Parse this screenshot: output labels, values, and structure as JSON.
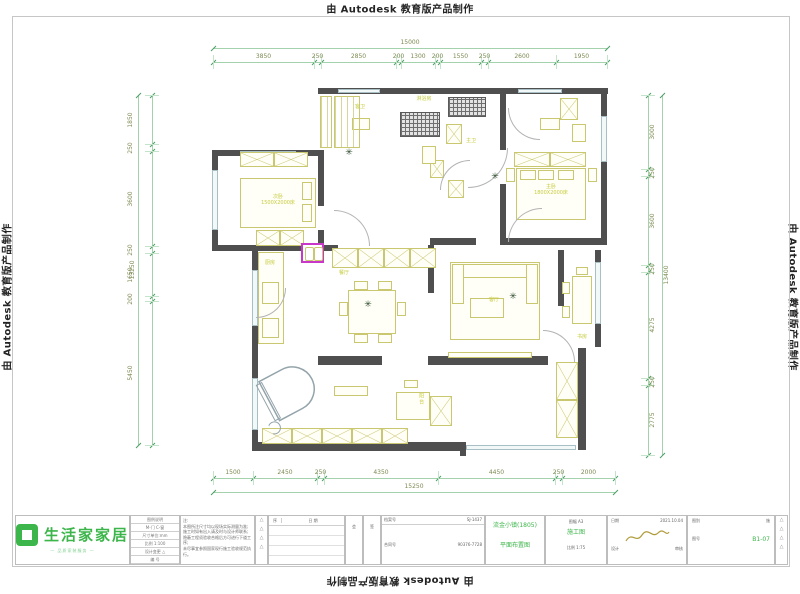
{
  "watermark": {
    "text": "由 Autodesk 教育版产品制作"
  },
  "plan": {
    "rooms": [
      {
        "label": "次卧",
        "sub": "1500X2000床",
        "x": 278,
        "y": 200,
        "vertical": false
      },
      {
        "label": "主卧",
        "sub": "1800X2000床",
        "x": 551,
        "y": 190,
        "vertical": false
      },
      {
        "label": "客厅",
        "sub": "",
        "x": 494,
        "y": 300,
        "vertical": false
      },
      {
        "label": "餐厅",
        "sub": "",
        "x": 344,
        "y": 273,
        "vertical": false
      },
      {
        "label": "厨房",
        "sub": "",
        "x": 270,
        "y": 263,
        "vertical": false
      },
      {
        "label": "书房",
        "sub": "",
        "x": 582,
        "y": 337,
        "vertical": false
      },
      {
        "label": "阳台",
        "sub": "",
        "x": 421,
        "y": 399,
        "vertical": true
      },
      {
        "label": "客卫",
        "sub": "",
        "x": 360,
        "y": 107,
        "vertical": false
      },
      {
        "label": "淋浴房",
        "sub": "",
        "x": 424,
        "y": 99,
        "vertical": false
      },
      {
        "label": "主卫",
        "sub": "",
        "x": 471,
        "y": 141,
        "vertical": false
      }
    ],
    "plants": [
      {
        "x": 349,
        "y": 153
      },
      {
        "x": 495,
        "y": 177
      },
      {
        "x": 368,
        "y": 305
      },
      {
        "x": 513,
        "y": 297
      }
    ],
    "colors": {
      "wall": "#4f4f4f",
      "furniture": "#c9c76f",
      "room_label": "#c6cc3e",
      "dimension": "#7c8a52",
      "highlight_magenta": "#c837c8",
      "logo_green": "#3cb54a"
    }
  },
  "dims": {
    "top": {
      "total": "15000",
      "labels": [
        "3850",
        "250",
        "2850",
        "200",
        "1300",
        "200",
        "1550",
        "250",
        "2600",
        "1950"
      ]
    },
    "bottom": {
      "total": "15250",
      "labels": [
        "1500",
        "2450",
        "250",
        "4350",
        "4450",
        "250",
        "2000"
      ]
    },
    "left": {
      "total": "13250",
      "labels": [
        "1850",
        "250",
        "3600",
        "250",
        "1650",
        "200",
        "5450"
      ]
    },
    "right": {
      "total": "13400",
      "labels": [
        "3000",
        "250",
        "3600",
        "250",
        "4275",
        "250",
        "2775"
      ]
    }
  },
  "titleblock": {
    "logo": {
      "brand": "生活家家居",
      "tagline": "— 品质家装服务 —"
    },
    "info_rows": [
      "图例说明",
      "M-门  C-窗",
      "尺寸单位:mm",
      "比例 1:100",
      "设计变更 △",
      "编 号"
    ],
    "notes": {
      "title": "注:",
      "lines": [
        "本图所注尺寸均以现场实际测量为准;",
        "施工时如有出入请及时与设计师联系;",
        "隐蔽工程须验收合格后方可进行下道工序;",
        "未尽事宜参照国家现行施工验收规范执行。"
      ]
    },
    "revision": {
      "no_label": "序",
      "date_label": "日 期",
      "marks": [
        "△",
        "△",
        "△",
        "△"
      ]
    },
    "sign_cols": [
      "会",
      "签"
    ],
    "fields": [
      {
        "label": "档案号",
        "value": "SJ-1437"
      },
      {
        "label": "合同号",
        "value": "90376-7728"
      }
    ],
    "project": {
      "name": "流金小镇(1805)",
      "drawing": "平面布置图"
    },
    "stage": {
      "sheet_label": "图幅",
      "sheet": "A3",
      "stage_label": "阶段",
      "stage": "施工图",
      "scale_label": "比例",
      "scale": "1:75"
    },
    "dateblock": {
      "date_label": "日期",
      "date": "2021.10.04",
      "designer_label": "设计",
      "checker_label": "审核"
    },
    "noblock": {
      "type_label": "图别",
      "type": "施",
      "no_label": "图号",
      "no": "B1-07"
    }
  }
}
